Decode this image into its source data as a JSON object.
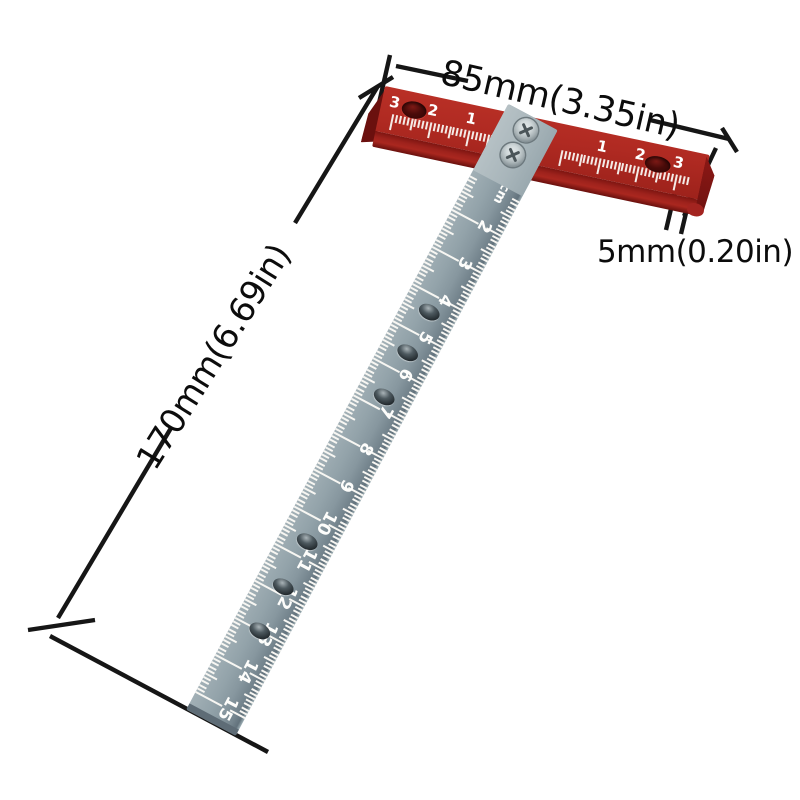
{
  "background": "#ffffff",
  "annotations": {
    "width": "85mm(3.35in)",
    "thickness": "5mm(0.20in)",
    "length": "170mm(6.69in)"
  },
  "head": {
    "color": "#b02a22",
    "left_scale_numbers": [
      "3",
      "2",
      "1"
    ],
    "right_scale_numbers": [
      "1",
      "2",
      "3"
    ],
    "hole_count": 2
  },
  "blade": {
    "color": "#8e9da4",
    "tick_color": "#ffffff",
    "labels": [
      "1cm",
      "2",
      "3",
      "4",
      "5",
      "6",
      "7",
      "8",
      "9",
      "10",
      "11",
      "12",
      "13",
      "14",
      "15"
    ],
    "hole_positions_cm": [
      4.4,
      5.5,
      6.7,
      10.6,
      11.8,
      13.0,
      15.5
    ],
    "screw_count": 2
  }
}
